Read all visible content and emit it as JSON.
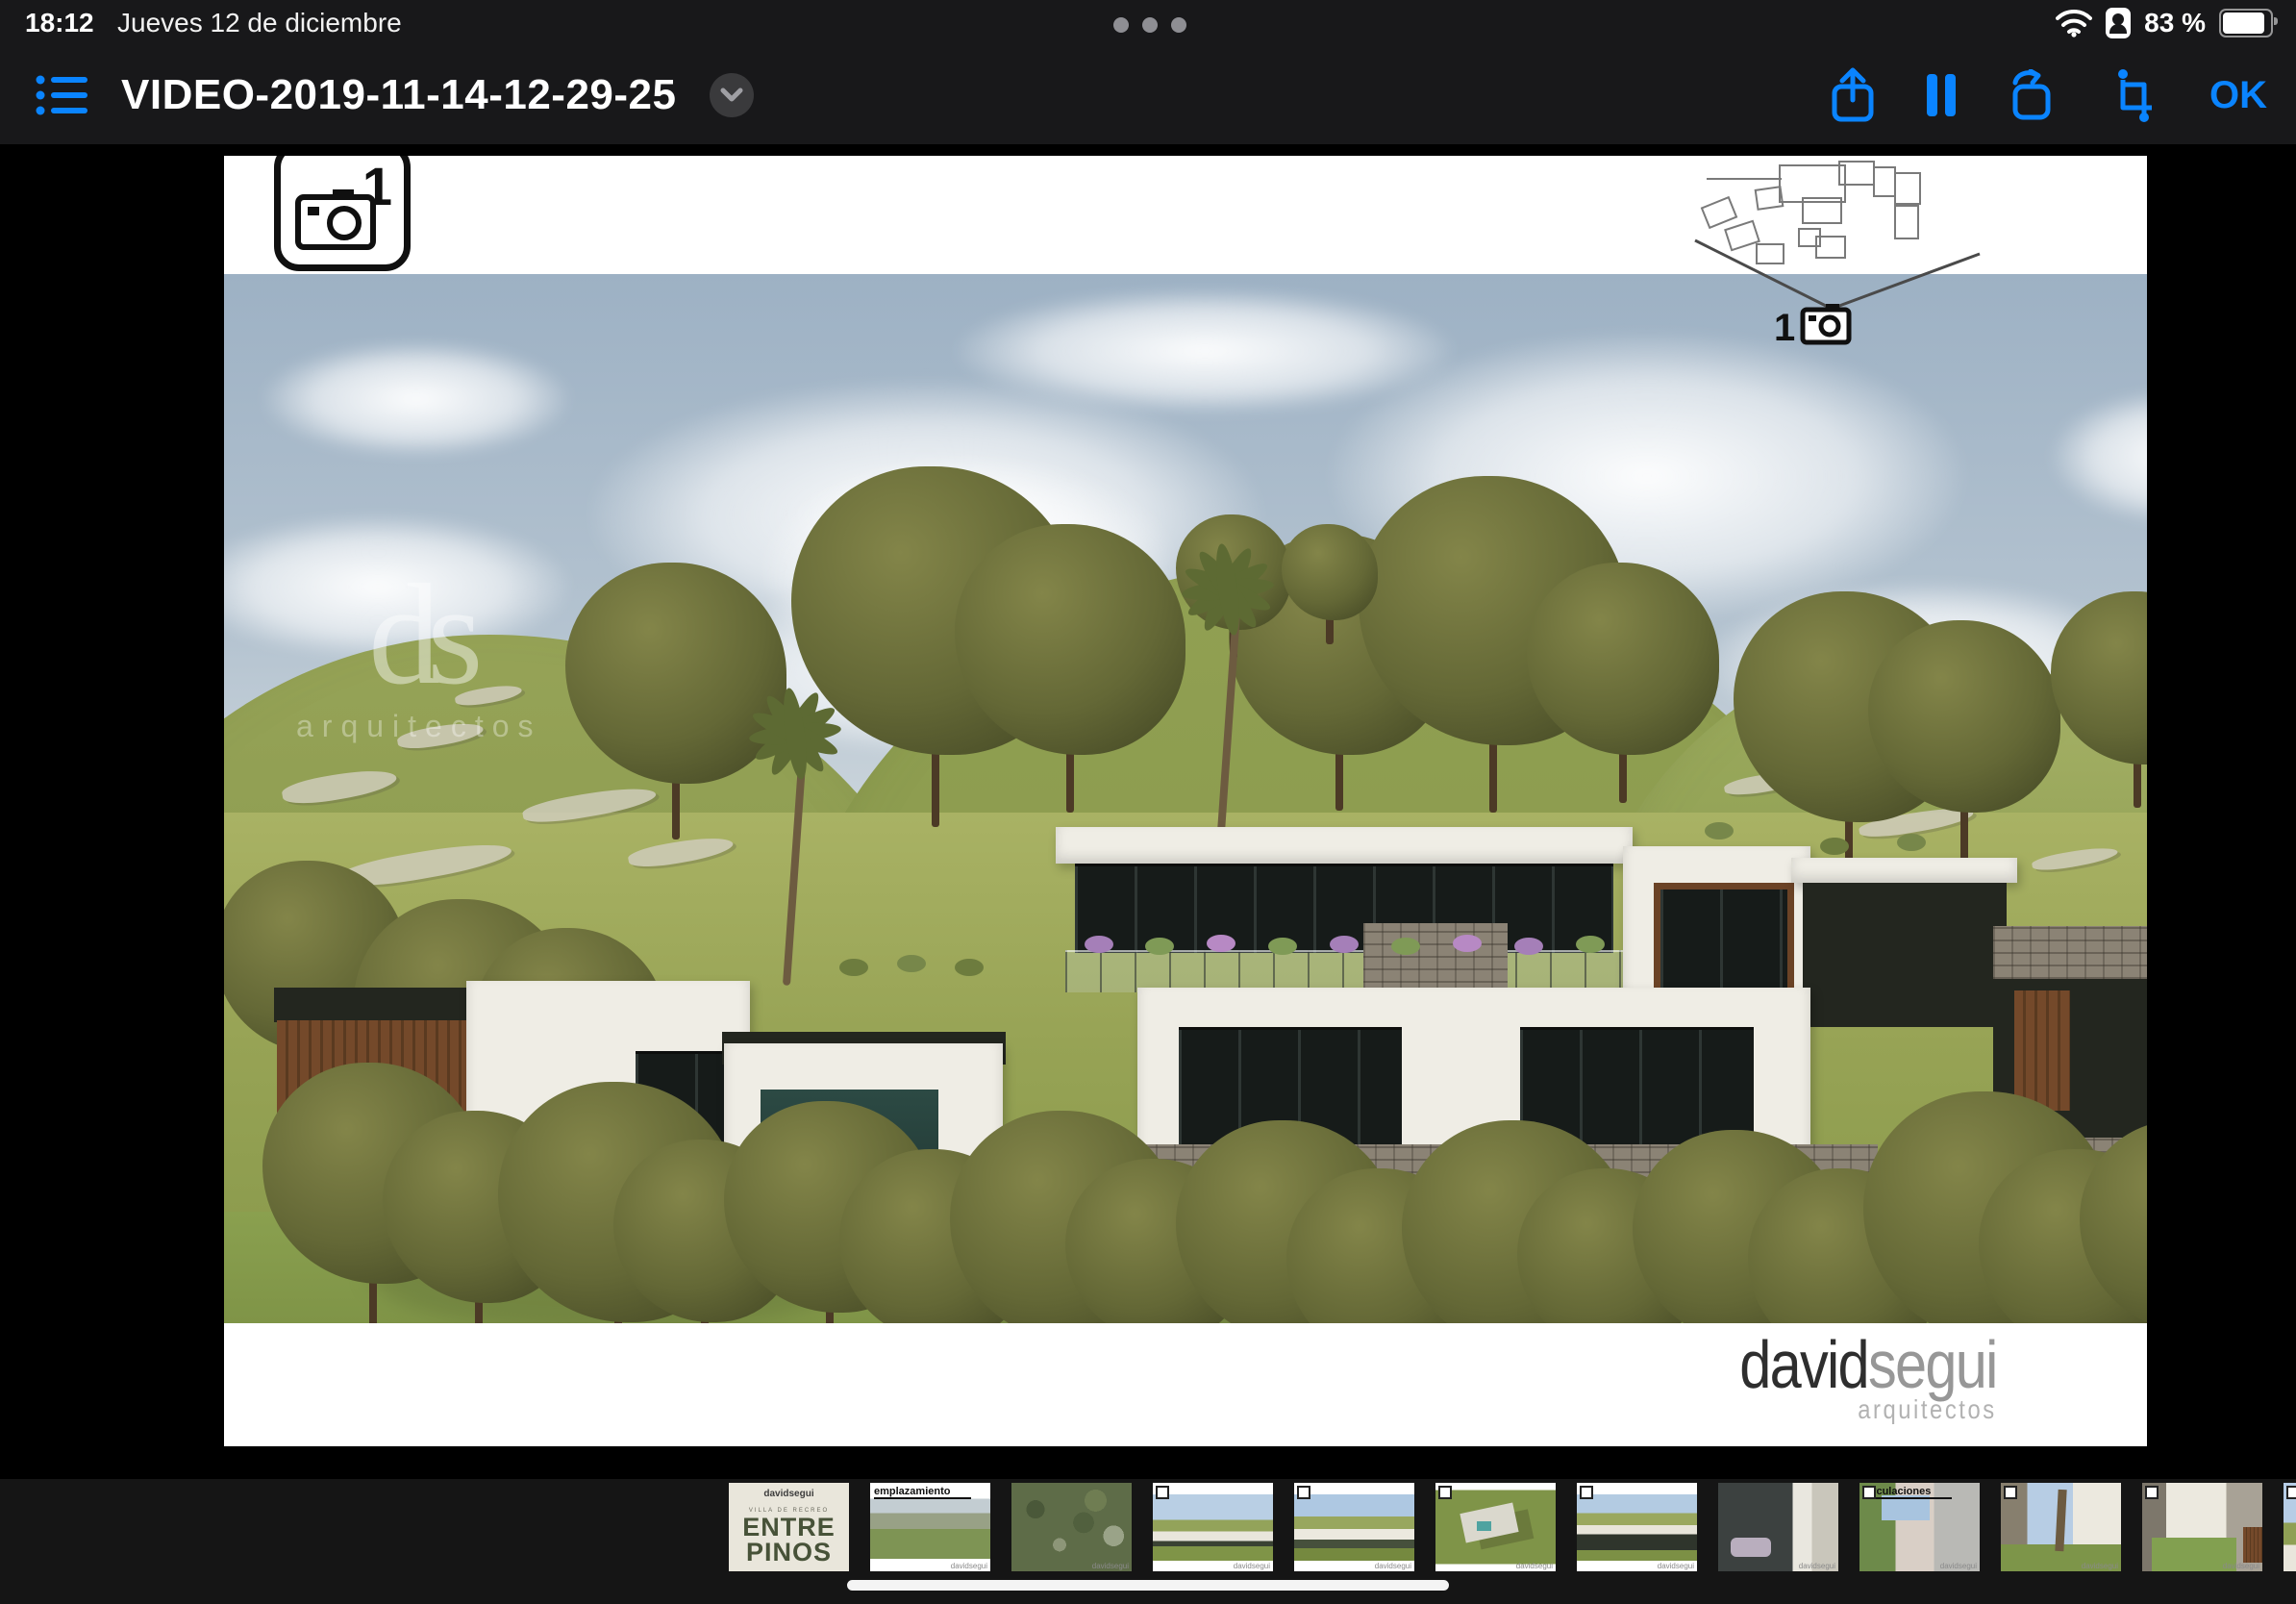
{
  "status_bar": {
    "time": "18:12",
    "date": "Jueves 12 de diciembre",
    "battery_percent": "83 %"
  },
  "toolbar": {
    "title": "VIDEO-2019-11-14-12-29-25",
    "ok_label": "OK"
  },
  "icons": {
    "list": "list-icon",
    "chevron": "chevron-down-icon",
    "share": "share-icon",
    "pause": "pause-icon",
    "rotate": "rotate-icon",
    "crop": "crop-icon",
    "wifi": "wifi-icon",
    "hotspot": "personal-hotspot-icon",
    "battery": "battery-icon",
    "camera": "camera-icon"
  },
  "video": {
    "camera_badge_number": "1",
    "diagram_camera_number": "1",
    "sky_logo_text": "ds",
    "sky_logo_subtitle": "arquitectos",
    "brand_primary": "david",
    "brand_secondary": "segui",
    "brand_subtitle": "arquitectos"
  },
  "filmstrip": {
    "watermark": "davidsegui",
    "thumbnails": [
      {
        "type": "title-slide",
        "brand": "davidsegui",
        "subtitle": "VILLA DE RECREO",
        "title_line1": "ENTRE",
        "title_line2": "PINOS"
      },
      {
        "type": "emplazamiento",
        "label": "emplazamiento"
      },
      {
        "type": "satellite"
      },
      {
        "type": "render-hillside"
      },
      {
        "type": "render-hillside-2"
      },
      {
        "type": "aerial-render"
      },
      {
        "type": "render-terrace"
      },
      {
        "type": "facade-dark"
      },
      {
        "type": "circulaciones",
        "label": "circulaciones"
      },
      {
        "type": "patio-palms"
      },
      {
        "type": "patio-lawn"
      },
      {
        "type": "render-partial"
      }
    ]
  },
  "colors": {
    "accent_blue": "#0a84ff",
    "header_bg": "#18181a",
    "stage_bg": "#000000",
    "filmstrip_bg": "#151515"
  }
}
